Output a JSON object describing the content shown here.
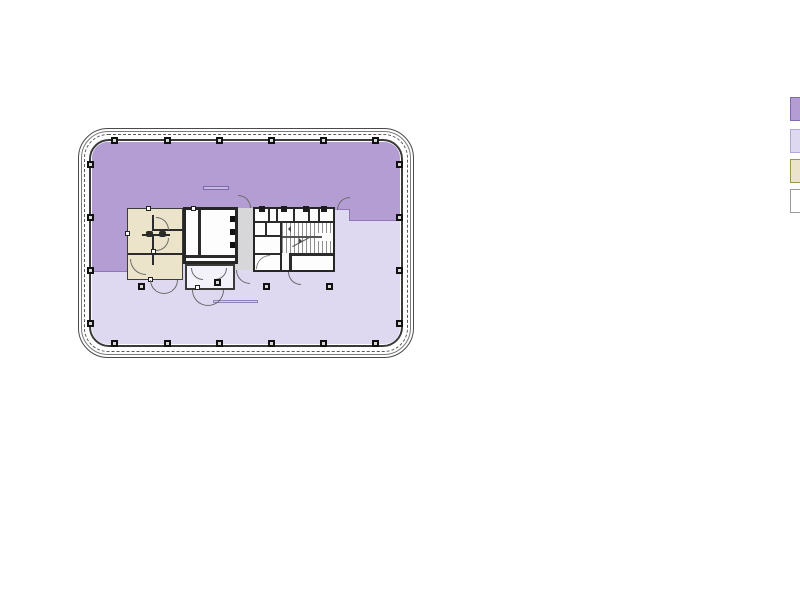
{
  "canvas": {
    "background": "#ffffff"
  },
  "floor_plan": {
    "type": "building-floor-plan",
    "zones": {
      "upper_tenant": {
        "fill": "#b49dd3",
        "edge": "#8f77b5"
      },
      "lower_tenant": {
        "fill": "#ded8f1",
        "edge": "#9a92c6"
      },
      "core_restrooms": {
        "fill": "#ebe4ca",
        "edge": "#3c3c3c"
      },
      "elevator_lobby": {
        "fill": "#d7d6d8"
      },
      "shafts_stairs": {
        "fill": "#fdfdfe",
        "wall": "#262626"
      }
    },
    "outline_color": "#4a4a4a",
    "column_marker_color": "#111111"
  },
  "legend": {
    "swatches": [
      {
        "id": "legend-upper-tenant-zone",
        "fill": "#b49dd3",
        "border": "#7f68ab"
      },
      {
        "id": "legend-lower-tenant-zone",
        "fill": "#ded8f1",
        "border": "#b0a9d6"
      },
      {
        "id": "legend-core-restrooms",
        "fill": "#ebe4ca",
        "border": "#99964f"
      },
      {
        "id": "legend-shafts-white",
        "fill": "#ffffff",
        "border": "#9a9a9a"
      }
    ]
  }
}
